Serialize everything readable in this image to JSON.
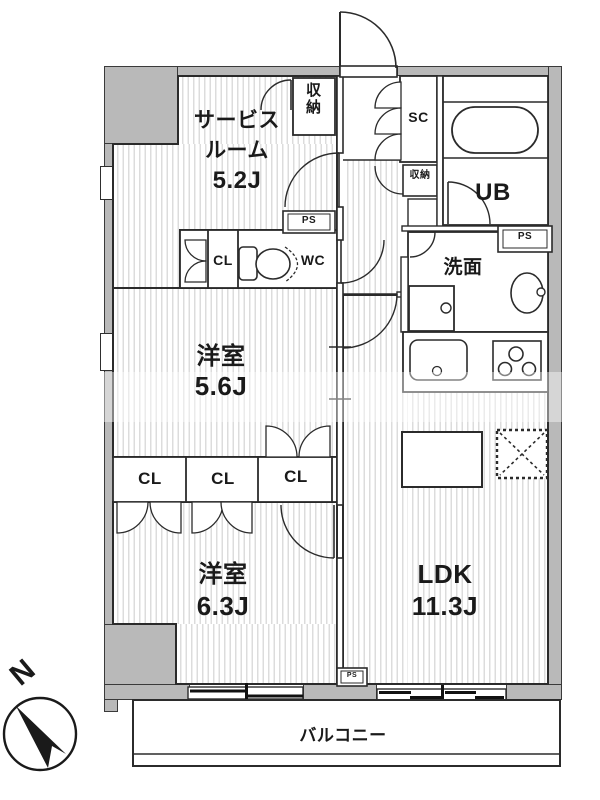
{
  "title": "apartment floor plan",
  "rooms": {
    "service_room": {
      "line1": "サービス",
      "line2": "ルーム",
      "size": "5.2J"
    },
    "bedroom_upper": {
      "name": "洋室",
      "size": "5.6J"
    },
    "bedroom_lower": {
      "name": "洋室",
      "size": "6.3J"
    },
    "ldk": {
      "name": "LDK",
      "size": "11.3J"
    },
    "washroom": {
      "name": "洗面"
    },
    "toilet": {
      "name": "WC"
    },
    "unit_bath": {
      "name": "UB"
    },
    "shoe_closet": {
      "name": "SC"
    },
    "balcony": {
      "name": "バルコニー"
    }
  },
  "storage": {
    "service_storage": "収納",
    "hall_storage": "収納",
    "hall_closet": "CL",
    "closet_1": "CL",
    "closet_2": "CL",
    "closet_3": "CL"
  },
  "shafts": {
    "ps_service": "PS",
    "ps_bath": "PS",
    "ps_ldk": "PS"
  },
  "compass": {
    "north": "N"
  },
  "colors": {
    "wall_fill": "#b9b9b9",
    "outline": "#2e2e2e",
    "floor_stripe": "#dcdcdc",
    "background": "#ffffff"
  }
}
